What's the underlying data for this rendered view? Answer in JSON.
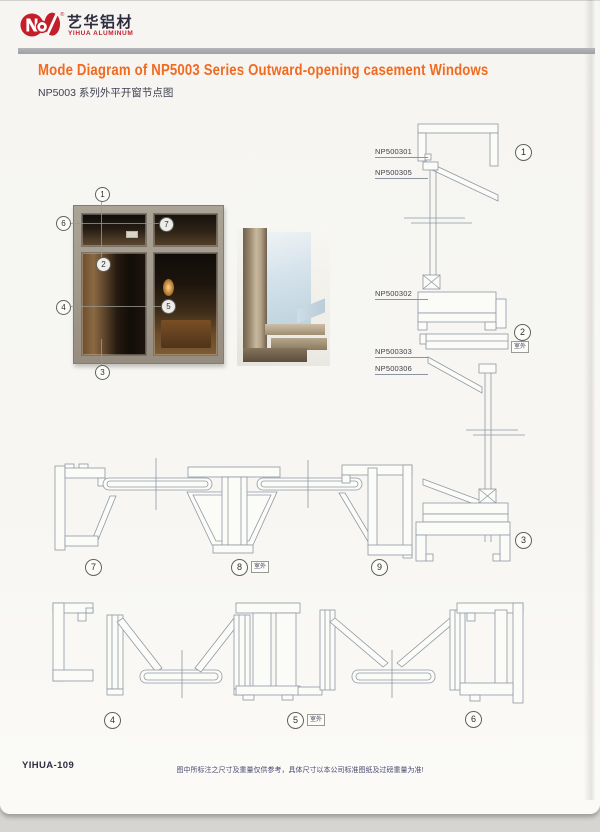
{
  "brand": {
    "name_cn": "艺华铝材",
    "name_en": "YIHUA ALUMINUM"
  },
  "header": {
    "title": "Mode Diagram of NP5003 Series Outward-opening casement Windows",
    "subtitle": "NP5003 系列外平开窗节点图"
  },
  "photo": {
    "callouts": [
      {
        "num": "1"
      },
      {
        "num": "2"
      },
      {
        "num": "3"
      },
      {
        "num": "4"
      },
      {
        "num": "5"
      },
      {
        "num": "6"
      },
      {
        "num": "7"
      }
    ]
  },
  "vertical_section": {
    "part_labels": [
      {
        "text": "NP500301"
      },
      {
        "text": "NP500305"
      },
      {
        "text": "NP500302"
      },
      {
        "text": "NP500303"
      },
      {
        "text": "NP500306"
      }
    ],
    "callouts": [
      {
        "num": "1"
      },
      {
        "num": "2",
        "tag": "室外"
      },
      {
        "num": "3"
      }
    ]
  },
  "middle_sections": {
    "callouts": [
      {
        "num": "7"
      },
      {
        "num": "8",
        "tag": "室外"
      },
      {
        "num": "9"
      }
    ]
  },
  "bottom_sections": {
    "callouts": [
      {
        "num": "4"
      },
      {
        "num": "5",
        "tag": "室外"
      },
      {
        "num": "6"
      }
    ]
  },
  "footer": {
    "code": "YIHUA-109",
    "note": "图中所标注之尺寸及重量仅供参考，具体尺寸以本公司标准图纸及过磅重量为准!"
  },
  "colors": {
    "accent_orange": "#f26a1f",
    "brand_red": "#c41e2a",
    "text_navy": "#30304a",
    "drawing_line": "#9098a4",
    "divider_gray": "#a8a9ad"
  }
}
